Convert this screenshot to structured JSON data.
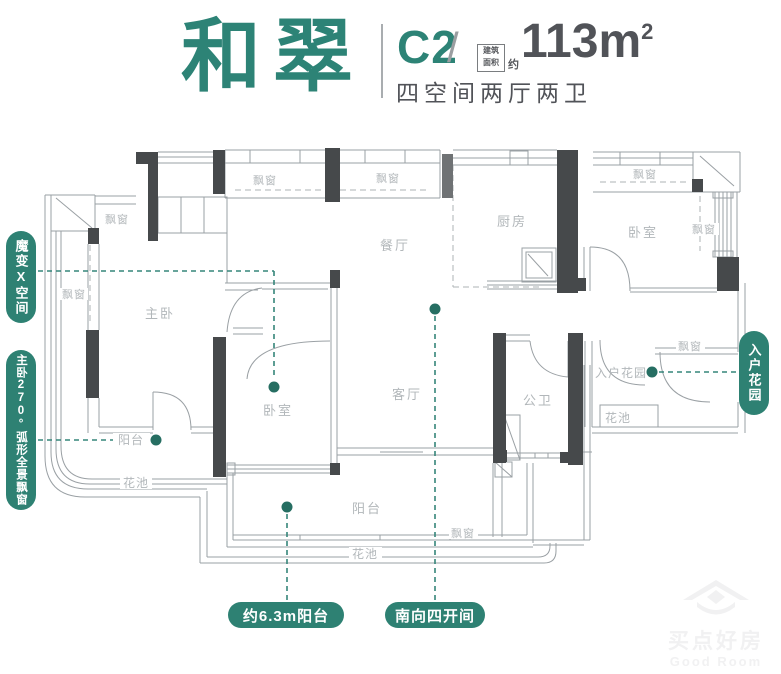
{
  "header": {
    "project_name": "和翠",
    "unit_code": "C2",
    "slash": "/",
    "area_box_line1": "建筑",
    "area_box_line2": "面积",
    "area_approx": "约",
    "area_value": "113m",
    "area_sup": "2",
    "subtitle": "四空间两厅两卫"
  },
  "callouts": {
    "magic_space": "魔变X空间",
    "bay_window_270": "主卧270°弧形全景飘窗",
    "entry_garden": "入户花园",
    "balcony_63": "约6.3m阳台",
    "south_facing": "南向四开间"
  },
  "rooms": {
    "master_bedroom": "主卧",
    "dining": "餐厅",
    "kitchen": "厨房",
    "bedroom": "卧室",
    "living": "客厅",
    "bath": "公卫",
    "entry_garden": "入户花园",
    "balcony": "阳台",
    "flower_bed": "花池",
    "bay_window": "飘窗"
  },
  "watermark": {
    "cn": "买点好房",
    "en": "Good Room"
  },
  "colors": {
    "accent_teal": "#2e8173",
    "wall_dark": "#46494b",
    "plan_line": "#9aa0a4",
    "room_label": "#b2b7ba"
  }
}
